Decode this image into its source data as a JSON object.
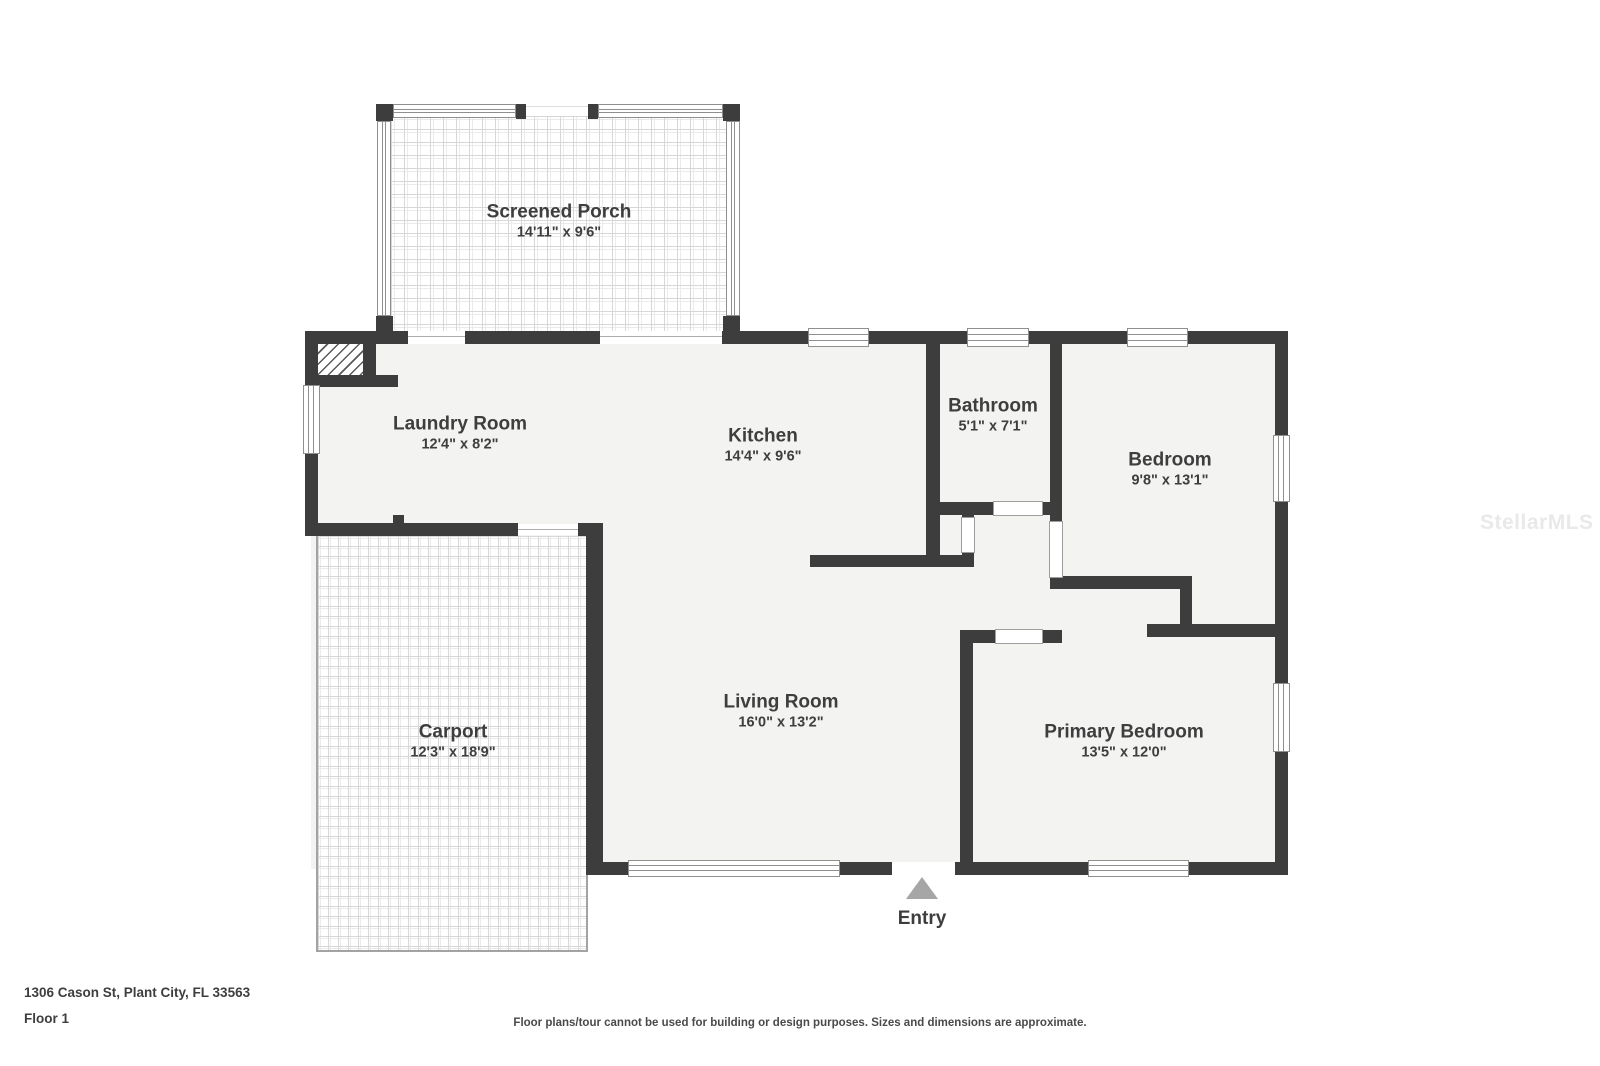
{
  "watermark": "StellarMLS",
  "entry": {
    "label": "Entry"
  },
  "rooms": {
    "screened_porch": {
      "name": "Screened Porch",
      "dims": "14'11\" x 9'6\""
    },
    "laundry_room": {
      "name": "Laundry Room",
      "dims": "12'4\" x 8'2\""
    },
    "kitchen": {
      "name": "Kitchen",
      "dims": "14'4\" x 9'6\""
    },
    "bathroom": {
      "name": "Bathroom",
      "dims": "5'1\" x 7'1\""
    },
    "bedroom": {
      "name": "Bedroom",
      "dims": "9'8\" x 13'1\""
    },
    "carport": {
      "name": "Carport",
      "dims": "12'3\" x 18'9\""
    },
    "living_room": {
      "name": "Living Room",
      "dims": "16'0\" x 13'2\""
    },
    "primary_bedroom": {
      "name": "Primary Bedroom",
      "dims": "13'5\" x 12'0\""
    }
  },
  "footer": {
    "address": "1306 Cason St, Plant City, FL 33563",
    "floor": "Floor 1",
    "disclaimer": "Floor plans/tour cannot be used for building or design purposes. Sizes and dimensions are approximate."
  },
  "colors": {
    "wall": "#3d3d3d",
    "floor": "#f3f3f2",
    "checker": "#d7d7d7",
    "checker-inner": "#ebebeb",
    "frame": "#8f8f8f",
    "text": "#3e3e3e",
    "entry-arrow": "#a6a6a6",
    "watermark": "#e9e9e9"
  }
}
